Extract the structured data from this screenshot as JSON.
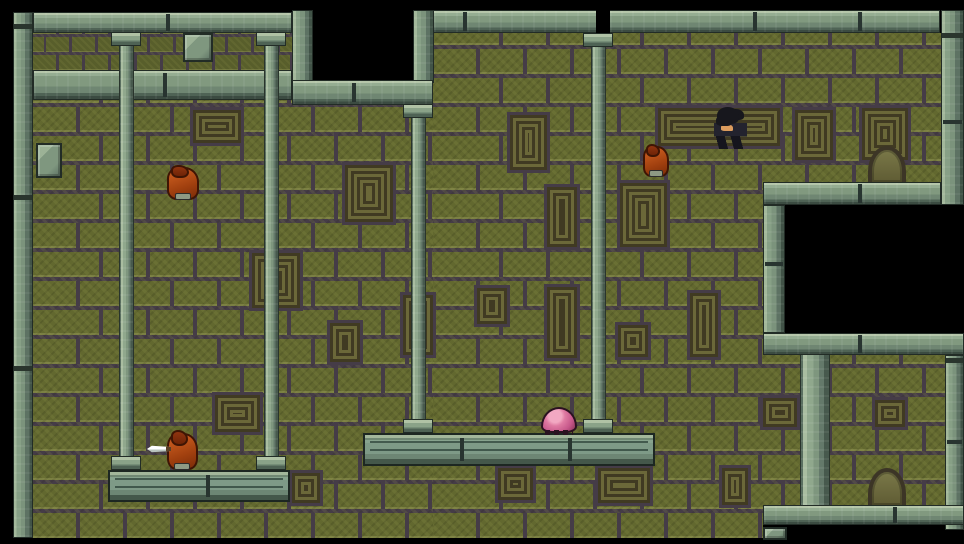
{
  "scene": {
    "width": 964,
    "height": 544
  },
  "palette": {
    "void": "#000000",
    "brick_olive": "#62682f",
    "mortar": "#453c47",
    "stone_mid": "#7f977f",
    "stone_light": "#b5c6aa",
    "stone_dark": "#3b4b41",
    "carving_line": "#403a22",
    "slime_pink": "#df7aa2",
    "imp_orange": "#a1400f",
    "hero_hair": "#17171d",
    "hero_skin": "#dc9c5e",
    "knife_blade": "#ffffff"
  },
  "elements": [
    {
      "name": "upper-brick-band",
      "cls": "bricks-small",
      "x": 33,
      "y": 33,
      "w": 259,
      "h": 37,
      "interactable": false
    },
    {
      "name": "right-brick-wall",
      "cls": "bricks-big",
      "x": 433,
      "y": 33,
      "w": 512,
      "h": 505,
      "interactable": false
    },
    {
      "name": "left-brick-wall",
      "cls": "bricks-big",
      "x": 33,
      "y": 100,
      "w": 400,
      "h": 438,
      "interactable": false
    },
    {
      "name": "wall-carving",
      "cls": "deco",
      "x": 193,
      "y": 110,
      "w": 48,
      "h": 33,
      "interactable": false
    },
    {
      "name": "wall-carving",
      "cls": "deco",
      "x": 658,
      "y": 108,
      "w": 122,
      "h": 38,
      "interactable": false
    },
    {
      "name": "wall-carving",
      "cls": "deco",
      "x": 795,
      "y": 110,
      "w": 38,
      "h": 50,
      "interactable": false
    },
    {
      "name": "wall-carving",
      "cls": "deco",
      "x": 862,
      "y": 108,
      "w": 46,
      "h": 52,
      "interactable": false
    },
    {
      "name": "wall-carving",
      "cls": "deco",
      "x": 510,
      "y": 115,
      "w": 37,
      "h": 55,
      "interactable": false
    },
    {
      "name": "wall-carving",
      "cls": "deco",
      "x": 345,
      "y": 165,
      "w": 48,
      "h": 57,
      "interactable": false
    },
    {
      "name": "wall-carving",
      "cls": "deco",
      "x": 547,
      "y": 187,
      "w": 30,
      "h": 60,
      "interactable": false
    },
    {
      "name": "wall-carving",
      "cls": "deco",
      "x": 620,
      "y": 183,
      "w": 47,
      "h": 64,
      "interactable": false
    },
    {
      "name": "wall-carving",
      "cls": "deco",
      "x": 252,
      "y": 253,
      "w": 48,
      "h": 55,
      "interactable": false
    },
    {
      "name": "wall-carving",
      "cls": "deco",
      "x": 330,
      "y": 323,
      "w": 30,
      "h": 39,
      "interactable": false
    },
    {
      "name": "wall-carving",
      "cls": "deco",
      "x": 477,
      "y": 288,
      "w": 30,
      "h": 36,
      "interactable": false
    },
    {
      "name": "wall-carving",
      "cls": "deco",
      "x": 547,
      "y": 287,
      "w": 30,
      "h": 71,
      "interactable": false
    },
    {
      "name": "wall-carving",
      "cls": "deco",
      "x": 618,
      "y": 325,
      "w": 30,
      "h": 32,
      "interactable": false
    },
    {
      "name": "wall-carving",
      "cls": "deco",
      "x": 690,
      "y": 293,
      "w": 28,
      "h": 64,
      "interactable": false
    },
    {
      "name": "wall-carving",
      "cls": "deco",
      "x": 403,
      "y": 295,
      "w": 30,
      "h": 60,
      "interactable": false
    },
    {
      "name": "wall-carving",
      "cls": "deco",
      "x": 215,
      "y": 395,
      "w": 45,
      "h": 37,
      "interactable": false
    },
    {
      "name": "wall-carving",
      "cls": "deco",
      "x": 763,
      "y": 398,
      "w": 34,
      "h": 29,
      "interactable": false
    },
    {
      "name": "wall-carving",
      "cls": "deco",
      "x": 875,
      "y": 400,
      "w": 30,
      "h": 27,
      "interactable": false
    },
    {
      "name": "wall-carving",
      "cls": "deco",
      "x": 292,
      "y": 473,
      "w": 28,
      "h": 30,
      "interactable": false
    },
    {
      "name": "wall-carving",
      "cls": "deco",
      "x": 498,
      "y": 468,
      "w": 35,
      "h": 32,
      "interactable": false
    },
    {
      "name": "wall-carving",
      "cls": "deco",
      "x": 598,
      "y": 468,
      "w": 52,
      "h": 35,
      "interactable": false
    },
    {
      "name": "wall-carving",
      "cls": "deco",
      "x": 722,
      "y": 468,
      "w": 26,
      "h": 37,
      "interactable": false
    },
    {
      "name": "top-void",
      "cls": "black",
      "x": 0,
      "y": 0,
      "w": 964,
      "h": 12,
      "interactable": false
    },
    {
      "name": "left-void",
      "cls": "black",
      "x": 0,
      "y": 0,
      "w": 13,
      "h": 544,
      "interactable": false
    },
    {
      "name": "ceiling-opening",
      "cls": "black",
      "x": 313,
      "y": 0,
      "w": 100,
      "h": 82,
      "interactable": false
    },
    {
      "name": "right-wall-opening",
      "cls": "black",
      "x": 785,
      "y": 205,
      "w": 179,
      "h": 128,
      "interactable": false
    },
    {
      "name": "lower-right-void",
      "cls": "black",
      "x": 763,
      "y": 525,
      "w": 201,
      "h": 19,
      "interactable": false
    },
    {
      "name": "bottom-void",
      "cls": "black",
      "x": 0,
      "y": 538,
      "w": 964,
      "h": 6,
      "interactable": false
    },
    {
      "name": "left-wall-edge",
      "cls": "strip",
      "x": 13,
      "y": 12,
      "w": 20,
      "h": 526,
      "interactable": false
    },
    {
      "name": "ceiling-beam-left",
      "cls": "beam",
      "x": 33,
      "y": 12,
      "w": 259,
      "h": 21,
      "interactable": false
    },
    {
      "name": "stone-seam",
      "cls": "seam",
      "x": 166,
      "y": 14,
      "w": 4,
      "h": 17,
      "interactable": false
    },
    {
      "name": "upper-ledge-beam",
      "cls": "beam",
      "x": 33,
      "y": 70,
      "w": 259,
      "h": 30,
      "interactable": false
    },
    {
      "name": "stone-seam",
      "cls": "seam",
      "x": 163,
      "y": 73,
      "w": 4,
      "h": 24,
      "interactable": false
    },
    {
      "name": "hanging-block",
      "cls": "box",
      "x": 183,
      "y": 33,
      "w": 30,
      "h": 29,
      "interactable": false
    },
    {
      "name": "wall-block",
      "cls": "box",
      "x": 36,
      "y": 143,
      "w": 26,
      "h": 35,
      "interactable": false
    },
    {
      "name": "opening-frame-left",
      "cls": "strip",
      "x": 292,
      "y": 10,
      "w": 21,
      "h": 73,
      "interactable": false
    },
    {
      "name": "opening-frame-right",
      "cls": "strip",
      "x": 413,
      "y": 10,
      "w": 21,
      "h": 73,
      "interactable": false
    },
    {
      "name": "opening-ledge",
      "cls": "beam",
      "x": 292,
      "y": 80,
      "w": 141,
      "h": 25,
      "interactable": false
    },
    {
      "name": "stone-seam",
      "cls": "seam",
      "x": 352,
      "y": 83,
      "w": 4,
      "h": 19,
      "interactable": false
    },
    {
      "name": "ceiling-beam-right",
      "cls": "beam",
      "x": 433,
      "y": 10,
      "w": 507,
      "h": 23,
      "interactable": false
    },
    {
      "name": "stone-seam",
      "cls": "seam",
      "x": 463,
      "y": 12,
      "w": 4,
      "h": 19,
      "interactable": false
    },
    {
      "name": "stone-seam",
      "cls": "seam",
      "x": 753,
      "y": 12,
      "w": 4,
      "h": 19,
      "interactable": false
    },
    {
      "name": "stone-seam",
      "cls": "seam",
      "x": 858,
      "y": 12,
      "w": 4,
      "h": 19,
      "interactable": false
    },
    {
      "name": "ceiling-gap",
      "cls": "black",
      "x": 596,
      "y": 0,
      "w": 14,
      "h": 33,
      "interactable": false
    },
    {
      "name": "right-wall-edge-upper",
      "cls": "strip",
      "x": 941,
      "y": 10,
      "w": 23,
      "h": 195,
      "interactable": false
    },
    {
      "name": "stone-seam",
      "cls": "seam",
      "x": 943,
      "y": 120,
      "w": 19,
      "h": 4,
      "interactable": false
    },
    {
      "name": "door-arch-upper",
      "cls": "arch",
      "x": 868,
      "y": 146,
      "w": 38,
      "h": 36,
      "interactable": false
    },
    {
      "name": "opening-top-beam",
      "cls": "beam",
      "x": 763,
      "y": 182,
      "w": 178,
      "h": 23,
      "interactable": false
    },
    {
      "name": "stone-seam",
      "cls": "seam",
      "x": 858,
      "y": 184,
      "w": 4,
      "h": 19,
      "interactable": false
    },
    {
      "name": "opening-side-frame",
      "cls": "strip",
      "x": 763,
      "y": 205,
      "w": 22,
      "h": 128,
      "interactable": false
    },
    {
      "name": "stone-seam",
      "cls": "seam",
      "x": 765,
      "y": 262,
      "w": 18,
      "h": 4,
      "interactable": false
    },
    {
      "name": "opening-bottom-beam",
      "cls": "beam",
      "x": 763,
      "y": 333,
      "w": 201,
      "h": 22,
      "interactable": false
    },
    {
      "name": "stone-seam",
      "cls": "seam",
      "x": 858,
      "y": 335,
      "w": 4,
      "h": 18,
      "interactable": false
    },
    {
      "name": "right-wall-edge-lower",
      "cls": "strip",
      "x": 945,
      "y": 355,
      "w": 19,
      "h": 175,
      "interactable": false
    },
    {
      "name": "stone-seam",
      "cls": "seam",
      "x": 947,
      "y": 440,
      "w": 15,
      "h": 4,
      "interactable": false
    },
    {
      "name": "wide-pillar",
      "cls": "shaft",
      "x": 800,
      "y": 355,
      "w": 30,
      "h": 150,
      "interactable": false
    },
    {
      "name": "door-arch-lower",
      "cls": "arch",
      "x": 868,
      "y": 468,
      "w": 38,
      "h": 37,
      "interactable": false
    },
    {
      "name": "lower-right-beam",
      "cls": "beam",
      "x": 763,
      "y": 505,
      "w": 201,
      "h": 20,
      "interactable": false
    },
    {
      "name": "stone-seam",
      "cls": "seam",
      "x": 893,
      "y": 507,
      "w": 4,
      "h": 16,
      "interactable": false
    },
    {
      "name": "stone-stub",
      "cls": "box",
      "x": 763,
      "y": 527,
      "w": 24,
      "h": 13,
      "interactable": false
    },
    {
      "name": "column-shaft-a",
      "cls": "shaft",
      "x": 119,
      "y": 32,
      "w": 15,
      "h": 426,
      "interactable": false
    },
    {
      "name": "column-shaft-b",
      "cls": "shaft",
      "x": 264,
      "y": 32,
      "w": 15,
      "h": 426,
      "interactable": false
    },
    {
      "name": "column-shaft-c",
      "cls": "shaft",
      "x": 411,
      "y": 104,
      "w": 15,
      "h": 318,
      "interactable": false
    },
    {
      "name": "column-shaft-d",
      "cls": "shaft",
      "x": 591,
      "y": 33,
      "w": 15,
      "h": 386,
      "interactable": false
    },
    {
      "name": "column-capital-a",
      "cls": "cap",
      "x": 111,
      "y": 32,
      "w": 30,
      "h": 14,
      "interactable": false
    },
    {
      "name": "column-capital-b",
      "cls": "cap",
      "x": 256,
      "y": 32,
      "w": 30,
      "h": 14,
      "interactable": false
    },
    {
      "name": "column-capital-c",
      "cls": "cap",
      "x": 403,
      "y": 104,
      "w": 30,
      "h": 14,
      "interactable": false
    },
    {
      "name": "column-capital-d",
      "cls": "cap",
      "x": 583,
      "y": 33,
      "w": 30,
      "h": 14,
      "interactable": false
    },
    {
      "name": "left-platform",
      "cls": "platform",
      "x": 108,
      "y": 470,
      "w": 182,
      "h": 32,
      "interactable": false
    },
    {
      "name": "stone-seam",
      "cls": "seam",
      "x": 206,
      "y": 475,
      "w": 4,
      "h": 22,
      "interactable": false
    },
    {
      "name": "middle-platform",
      "cls": "platform",
      "x": 363,
      "y": 433,
      "w": 292,
      "h": 33,
      "interactable": false
    },
    {
      "name": "stone-seam",
      "cls": "seam",
      "x": 460,
      "y": 438,
      "w": 4,
      "h": 23,
      "interactable": false
    },
    {
      "name": "stone-seam",
      "cls": "seam",
      "x": 568,
      "y": 438,
      "w": 4,
      "h": 23,
      "interactable": false
    },
    {
      "name": "column-base-a",
      "cls": "cap",
      "x": 111,
      "y": 456,
      "w": 30,
      "h": 14,
      "interactable": false
    },
    {
      "name": "column-base-b",
      "cls": "cap",
      "x": 256,
      "y": 456,
      "w": 30,
      "h": 14,
      "interactable": false
    },
    {
      "name": "column-base-c",
      "cls": "cap",
      "x": 403,
      "y": 419,
      "w": 30,
      "h": 14,
      "interactable": false
    },
    {
      "name": "column-base-d",
      "cls": "cap",
      "x": 583,
      "y": 419,
      "w": 30,
      "h": 14,
      "interactable": false
    },
    {
      "name": "slime-enemy",
      "cls": "slime",
      "x": 541,
      "y": 407,
      "w": 36,
      "h": 26,
      "interactable": true
    },
    {
      "name": "imp-enemy-upper-left",
      "cls": "imp",
      "x": 167,
      "y": 167,
      "w": 32,
      "h": 33,
      "interactable": true
    },
    {
      "name": "imp-enemy-upper-right",
      "cls": "imp",
      "x": 643,
      "y": 146,
      "w": 26,
      "h": 31,
      "interactable": true
    },
    {
      "name": "hero-character",
      "cls": "hero",
      "x": 714,
      "y": 107,
      "w": 33,
      "h": 42,
      "interactable": true
    },
    {
      "name": "imp-enemy-lower",
      "cls": "imp",
      "x": 167,
      "y": 433,
      "w": 31,
      "h": 37,
      "interactable": true
    },
    {
      "name": "knife-blade",
      "cls": "knife",
      "x": 147,
      "y": 445,
      "w": 24,
      "h": 8,
      "interactable": false
    }
  ]
}
